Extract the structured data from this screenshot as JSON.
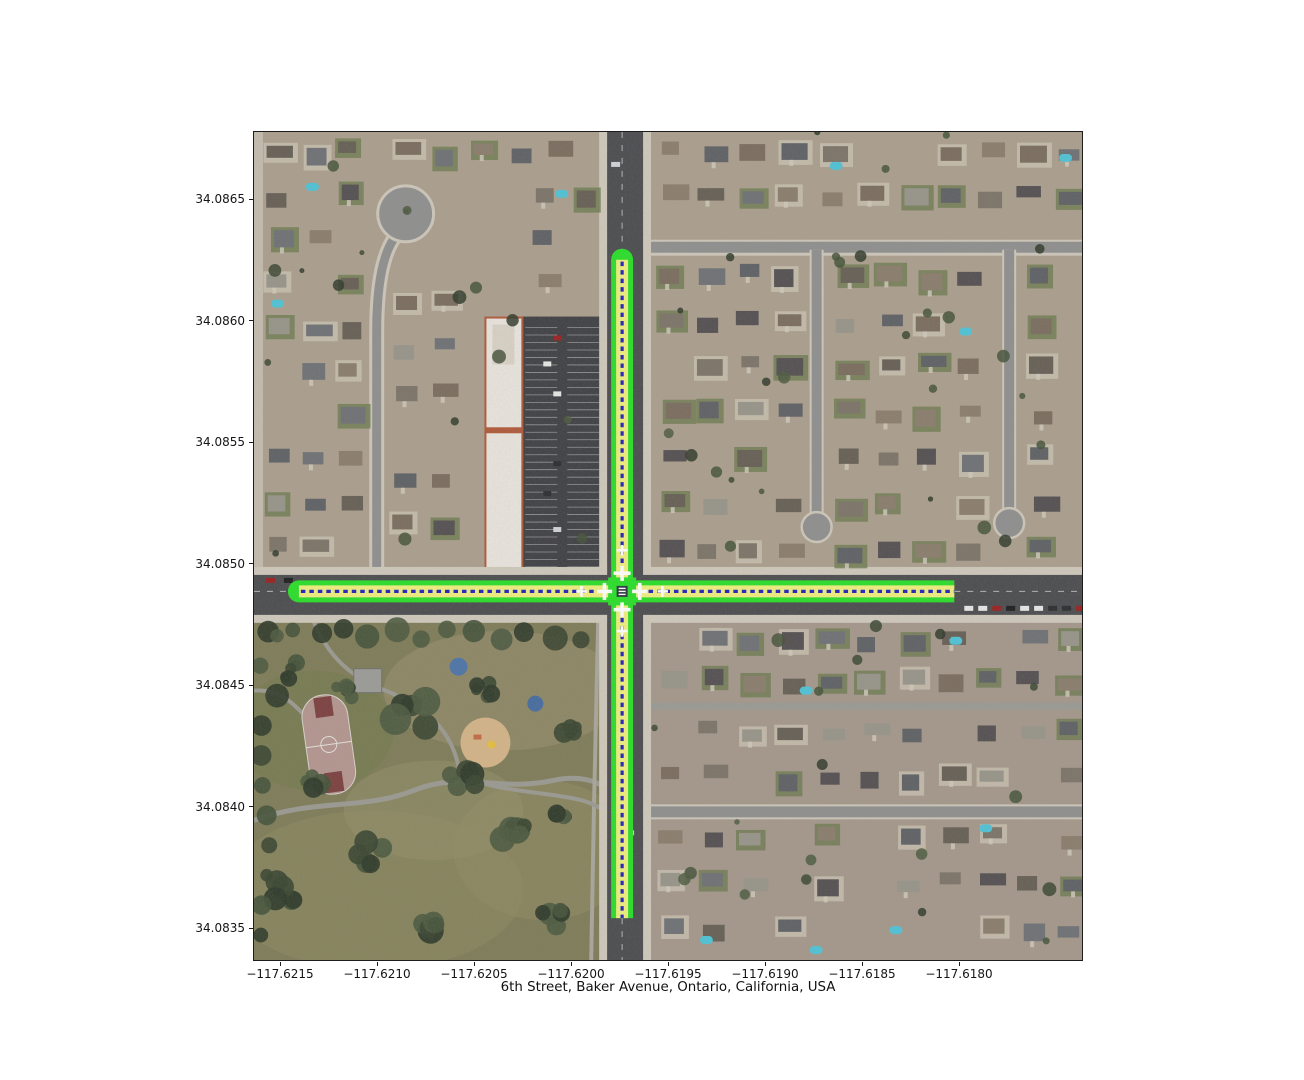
{
  "figure": {
    "title": "6th Street, Baker Avenue, Ontario, California, USA",
    "x_axis": {
      "tick_labels": [
        "−117.6215",
        "−117.6210",
        "−117.6205",
        "−117.6200",
        "−117.6195",
        "−117.6190",
        "−117.6185",
        "−117.6180"
      ]
    },
    "y_axis": {
      "tick_labels": [
        "34.0865",
        "34.0860",
        "34.0855",
        "34.0850",
        "34.0845",
        "34.0840",
        "34.0835"
      ]
    }
  },
  "map": {
    "kind": "aerial-satellite-with-lane-network-overlay",
    "highlighted_roads": [
      "6th Street",
      "Baker Avenue"
    ],
    "colors": {
      "lane_edge_green": "#29df29",
      "lane_fill_yellow": "#f0ef7e",
      "lane_divider_blue": "#2121bd",
      "road_marking_white": "#ffffff",
      "asphalt": "#4b4c4f",
      "park_green": "#7e7c58"
    }
  }
}
